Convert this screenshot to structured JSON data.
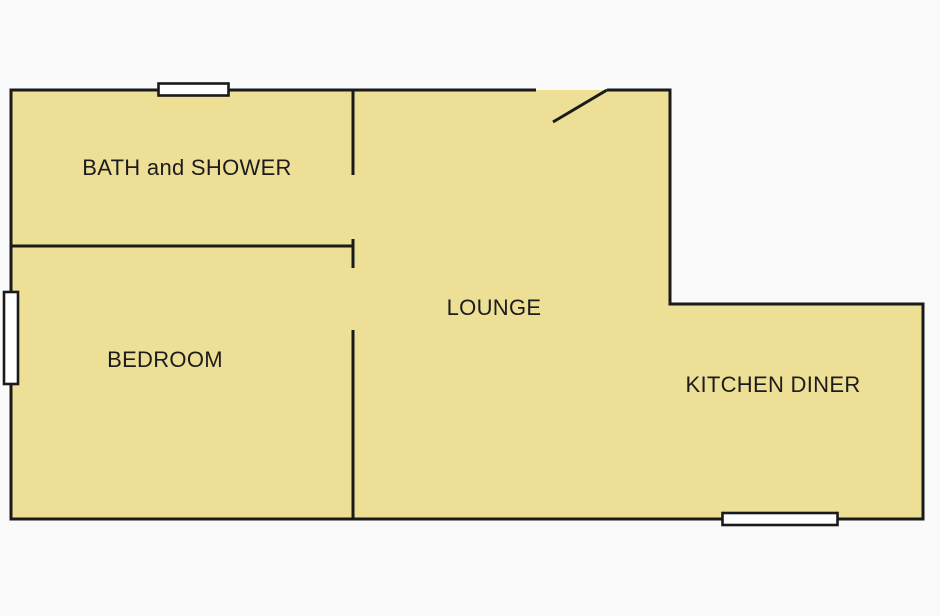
{
  "canvas": {
    "background": "#FAFAFA"
  },
  "floorplan": {
    "colors": {
      "floor_fill": "#EDDF96",
      "wall_stroke": "#1A1A1A",
      "window_fill": "#FFFFFF",
      "label_color": "#1C1C1C"
    },
    "rooms": [
      {
        "id": "bath-and-shower",
        "label": "BATH and SHOWER"
      },
      {
        "id": "bedroom",
        "label": "BEDROOM"
      },
      {
        "id": "lounge",
        "label": "LOUNGE"
      },
      {
        "id": "kitchen-diner",
        "label": "KITCHEN DINER"
      }
    ],
    "features": {
      "windows": [
        "top-wall-window",
        "left-wall-window",
        "bottom-wall-window"
      ],
      "doors": [
        "entrance-door-swing"
      ]
    }
  }
}
